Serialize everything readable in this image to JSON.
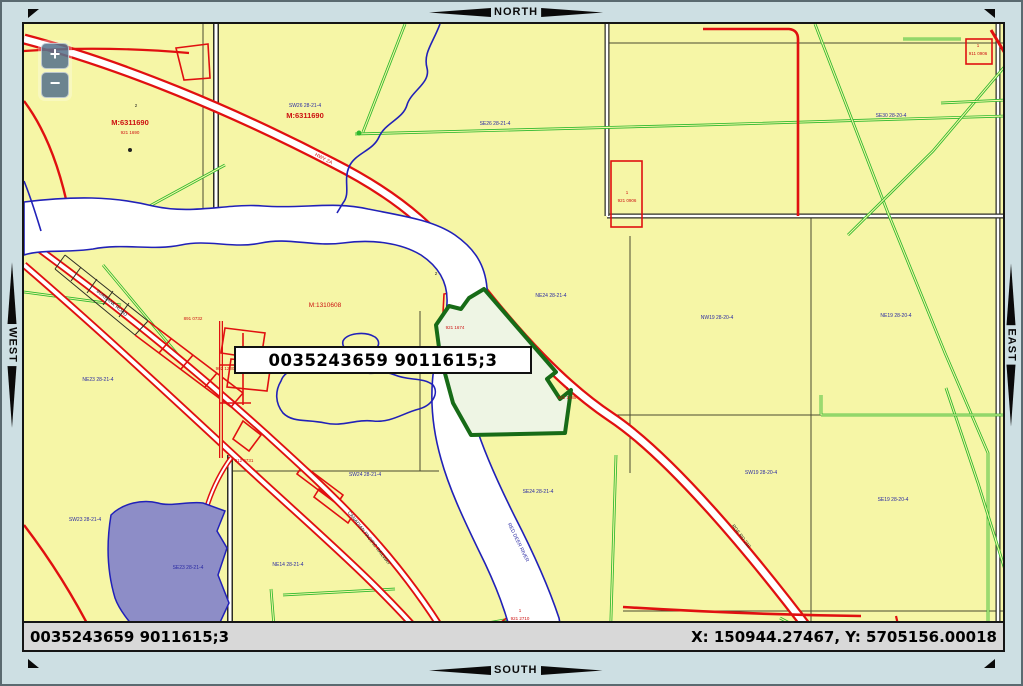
{
  "nav": {
    "north": "NORTH",
    "south": "SOUTH",
    "east": "EAST",
    "west": "WEST"
  },
  "zoom_controls": {
    "zoom_in": "+",
    "zoom_out": "−"
  },
  "selection_label": "0035243659 9011615;3",
  "status_bar": {
    "left": "0035243659 9011615;3",
    "right": "X: 150944.27467, Y: 5705156.00018"
  },
  "palette": {
    "frame_band": "#cddfe3",
    "map_bg": "#f6f6a6",
    "road_red": "#e01010",
    "road_casing": "#2e2e24",
    "pipeline_green": "#2db82d",
    "water_blue": "#2121b8",
    "river_fill": "#ffffff",
    "parcel_purple": "#8d8dc7",
    "highlight_fill": "#eef5e4",
    "highlight_stroke": "#176b17",
    "status_bg": "#d8d8d8",
    "blue_label": "#2929a3",
    "red_label": "#cc1111",
    "black_label": "#222222",
    "zoom_btn_bg": "rgba(77,106,133,0.82)"
  },
  "map_labels": [
    {
      "t": "SW26 28-21-4",
      "x": 302,
      "y": 104,
      "c": "blue",
      "s": 5
    },
    {
      "t": "M:6311690",
      "x": 302,
      "y": 115,
      "c": "red",
      "s": 7.5,
      "b": 1
    },
    {
      "t": "2",
      "x": 133,
      "y": 104,
      "c": "black",
      "s": 4.5
    },
    {
      "t": "M:6311690",
      "x": 127,
      "y": 122,
      "c": "red",
      "s": 7.5,
      "b": 1
    },
    {
      "t": "921 1690",
      "x": 127,
      "y": 131,
      "c": "red",
      "s": 4.5
    },
    {
      "t": "SE26 28-21-4",
      "x": 492,
      "y": 122,
      "c": "blue",
      "s": 5
    },
    {
      "t": "SE30 28-20-4",
      "x": 888,
      "y": 114,
      "c": "blue",
      "s": 5
    },
    {
      "t": "M:1310608",
      "x": 322,
      "y": 304,
      "c": "red",
      "s": 6.5
    },
    {
      "t": "NE24 28-21-4",
      "x": 548,
      "y": 294,
      "c": "blue",
      "s": 5
    },
    {
      "t": "NW19 28-20-4",
      "x": 714,
      "y": 316,
      "c": "blue",
      "s": 5
    },
    {
      "t": "NE19 28-20-4",
      "x": 893,
      "y": 314,
      "c": "blue",
      "s": 5
    },
    {
      "t": "NE23 28-21-4",
      "x": 95,
      "y": 378,
      "c": "blue",
      "s": 5
    },
    {
      "t": "SW23 28-21-4",
      "x": 82,
      "y": 518,
      "c": "blue",
      "s": 5
    },
    {
      "t": "SE23 28-21-4",
      "x": 185,
      "y": 566,
      "c": "blue",
      "s": 5
    },
    {
      "t": "SW24 28-21-4",
      "x": 362,
      "y": 473,
      "c": "blue",
      "s": 5
    },
    {
      "t": "SE24 28-21-4",
      "x": 535,
      "y": 490,
      "c": "blue",
      "s": 5
    },
    {
      "t": "SW19 28-20-4",
      "x": 758,
      "y": 471,
      "c": "blue",
      "s": 5
    },
    {
      "t": "SE19 28-20-4",
      "x": 890,
      "y": 498,
      "c": "blue",
      "s": 5
    },
    {
      "t": "NE14 28-21-4",
      "x": 285,
      "y": 563,
      "c": "blue",
      "s": 5
    },
    {
      "t": "1",
      "x": 624,
      "y": 191,
      "c": "red",
      "s": 4.5
    },
    {
      "t": "921 0906",
      "x": 624,
      "y": 199,
      "c": "red",
      "s": 4.5
    },
    {
      "t": "1",
      "x": 975,
      "y": 44,
      "c": "red",
      "s": 4.5
    },
    {
      "t": "911 0906",
      "x": 975,
      "y": 52,
      "c": "red",
      "s": 4.5
    },
    {
      "t": "921 1674",
      "x": 452,
      "y": 326,
      "c": "red",
      "s": 4.5
    },
    {
      "t": "5",
      "x": 564,
      "y": 387,
      "c": "red",
      "s": 4.5
    },
    {
      "t": "921 1685",
      "x": 564,
      "y": 396,
      "c": "red",
      "s": 4.5
    },
    {
      "t": "1",
      "x": 517,
      "y": 609,
      "c": "red",
      "s": 4.5
    },
    {
      "t": "921 2710",
      "x": 517,
      "y": 617,
      "c": "red",
      "s": 4.5
    },
    {
      "t": "921 2030",
      "x": 247,
      "y": 349,
      "c": "red",
      "s": 4.5
    },
    {
      "t": "902 1230",
      "x": 222,
      "y": 367,
      "c": "red",
      "s": 4.5
    },
    {
      "t": "891 0732",
      "x": 190,
      "y": 317,
      "c": "red",
      "s": 4.5
    },
    {
      "t": "912 0731",
      "x": 241,
      "y": 459,
      "c": "red",
      "s": 4.5
    },
    {
      "t": "HWY 2A",
      "x": 320,
      "y": 157,
      "c": "red",
      "s": 5,
      "r": 27
    },
    {
      "t": "CANADIAN PACIFIC RAILWAY",
      "x": 365,
      "y": 536,
      "c": "black",
      "s": 4.8,
      "r": 52
    },
    {
      "t": "BURBANK ROAD",
      "x": 108,
      "y": 301,
      "c": "black",
      "s": 4.8,
      "r": 40
    },
    {
      "t": "RGE RD 210",
      "x": 737,
      "y": 534,
      "c": "black",
      "s": 4.8,
      "r": 53
    },
    {
      "t": "RED DEER RIVER",
      "x": 514,
      "y": 540,
      "c": "blue",
      "s": 5,
      "r": 64
    },
    {
      "t": "2",
      "x": 433,
      "y": 272,
      "c": "black",
      "s": 4.5
    }
  ]
}
